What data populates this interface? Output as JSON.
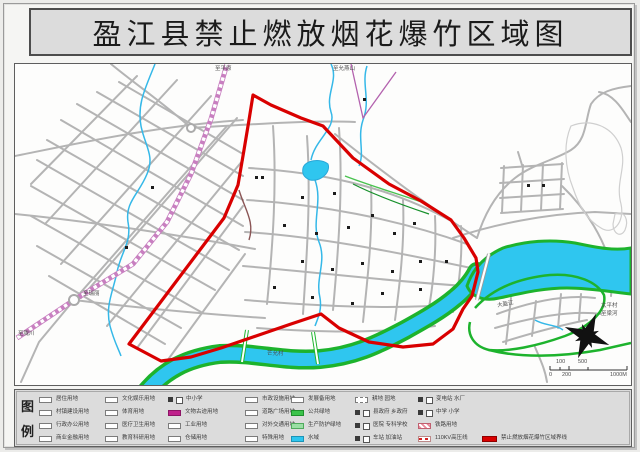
{
  "title": "盈江县禁止燃放烟花爆竹区域图",
  "legend": {
    "caption_top": "图",
    "caption_bottom": "例",
    "items": [
      {
        "x": 24,
        "y": 6,
        "swatch": "box",
        "label": "居住用地"
      },
      {
        "x": 24,
        "y": 19,
        "swatch": "box",
        "label": "村镇建设用地"
      },
      {
        "x": 24,
        "y": 32,
        "swatch": "box",
        "label": "行政办公用地"
      },
      {
        "x": 24,
        "y": 45,
        "swatch": "box",
        "label": "商业金融用地"
      },
      {
        "x": 90,
        "y": 6,
        "swatch": "box",
        "label": "文化娱乐用地"
      },
      {
        "x": 90,
        "y": 19,
        "swatch": "box",
        "label": "体育用地"
      },
      {
        "x": 90,
        "y": 32,
        "swatch": "box",
        "label": "医疗卫生用地"
      },
      {
        "x": 90,
        "y": 45,
        "swatch": "box",
        "label": "教育科研用地"
      },
      {
        "x": 153,
        "y": 6,
        "swatch": "pair",
        "label": "中小学"
      },
      {
        "x": 153,
        "y": 19,
        "swatch": "magenta",
        "label": "文物古迹用地"
      },
      {
        "x": 153,
        "y": 32,
        "swatch": "box",
        "label": "工业用地"
      },
      {
        "x": 153,
        "y": 45,
        "swatch": "box",
        "label": "仓储用地"
      },
      {
        "x": 230,
        "y": 6,
        "swatch": "box",
        "label": "市政设施用地"
      },
      {
        "x": 230,
        "y": 19,
        "swatch": "box",
        "label": "道路广场用地"
      },
      {
        "x": 230,
        "y": 32,
        "swatch": "box",
        "label": "对外交通用地"
      },
      {
        "x": 230,
        "y": 45,
        "swatch": "box",
        "label": "特殊用地"
      },
      {
        "x": 276,
        "y": 6,
        "swatch": "box",
        "label": "发展备用地"
      },
      {
        "x": 276,
        "y": 19,
        "swatch": "green",
        "label": "公共绿地"
      },
      {
        "x": 276,
        "y": 32,
        "swatch": "lightgreen",
        "label": "生产防护绿地"
      },
      {
        "x": 276,
        "y": 45,
        "swatch": "blue",
        "label": "水域"
      },
      {
        "x": 340,
        "y": 6,
        "swatch": "dashed",
        "label": "耕地 园地"
      },
      {
        "x": 340,
        "y": 19,
        "swatch": "pair",
        "label": "县政府 乡政府"
      },
      {
        "x": 340,
        "y": 32,
        "swatch": "pair",
        "label": "医院 专科学校"
      },
      {
        "x": 340,
        "y": 45,
        "swatch": "pair",
        "label": "车站 加油站"
      },
      {
        "x": 403,
        "y": 6,
        "swatch": "pair",
        "label": "变电站 水厂"
      },
      {
        "x": 403,
        "y": 19,
        "swatch": "pair",
        "label": "中学 小学"
      },
      {
        "x": 403,
        "y": 32,
        "swatch": "hatch",
        "label": "铁路用地"
      },
      {
        "x": 403,
        "y": 45,
        "swatch": "redline",
        "label": "110KV高压线"
      },
      {
        "x": 467,
        "y": 45,
        "swatch": "redzone",
        "label": "禁止燃放烟花爆竹区域界线"
      }
    ]
  },
  "map": {
    "labels": [
      {
        "text": "至平原",
        "x": 200,
        "y": 3,
        "rot": 0
      },
      {
        "text": "至允燕山",
        "x": 318,
        "y": 3,
        "rot": 0
      },
      {
        "text": "至瑞丽",
        "x": 68,
        "y": 228,
        "rot": 0
      },
      {
        "text": "至陇川",
        "x": 3,
        "y": 268,
        "rot": 0
      },
      {
        "text": "太平村",
        "x": 586,
        "y": 240,
        "rot": 0
      },
      {
        "text": "至梁河",
        "x": 586,
        "y": 248,
        "rot": 0
      },
      {
        "text": "芒允村",
        "x": 252,
        "y": 288,
        "rot": 0
      },
      {
        "text": "大盈江",
        "x": 482,
        "y": 240,
        "rot": -10
      },
      {
        "text": "100",
        "x": 541,
        "y": 296,
        "rot": 0
      },
      {
        "text": "500",
        "x": 563,
        "y": 296,
        "rot": 0
      },
      {
        "text": "0",
        "x": 534,
        "y": 309,
        "rot": 0
      },
      {
        "text": "200",
        "x": 547,
        "y": 309,
        "rot": 0
      },
      {
        "text": "1000M",
        "x": 595,
        "y": 309,
        "rot": 0
      }
    ],
    "colors": {
      "prohibition_boundary": "#d90000",
      "water": "#2fc6ef",
      "greenbelt": "#1db32d",
      "railway": "#c87fc0",
      "road": "#b4b4b4",
      "panel_gray": "#dcdcdc"
    }
  }
}
